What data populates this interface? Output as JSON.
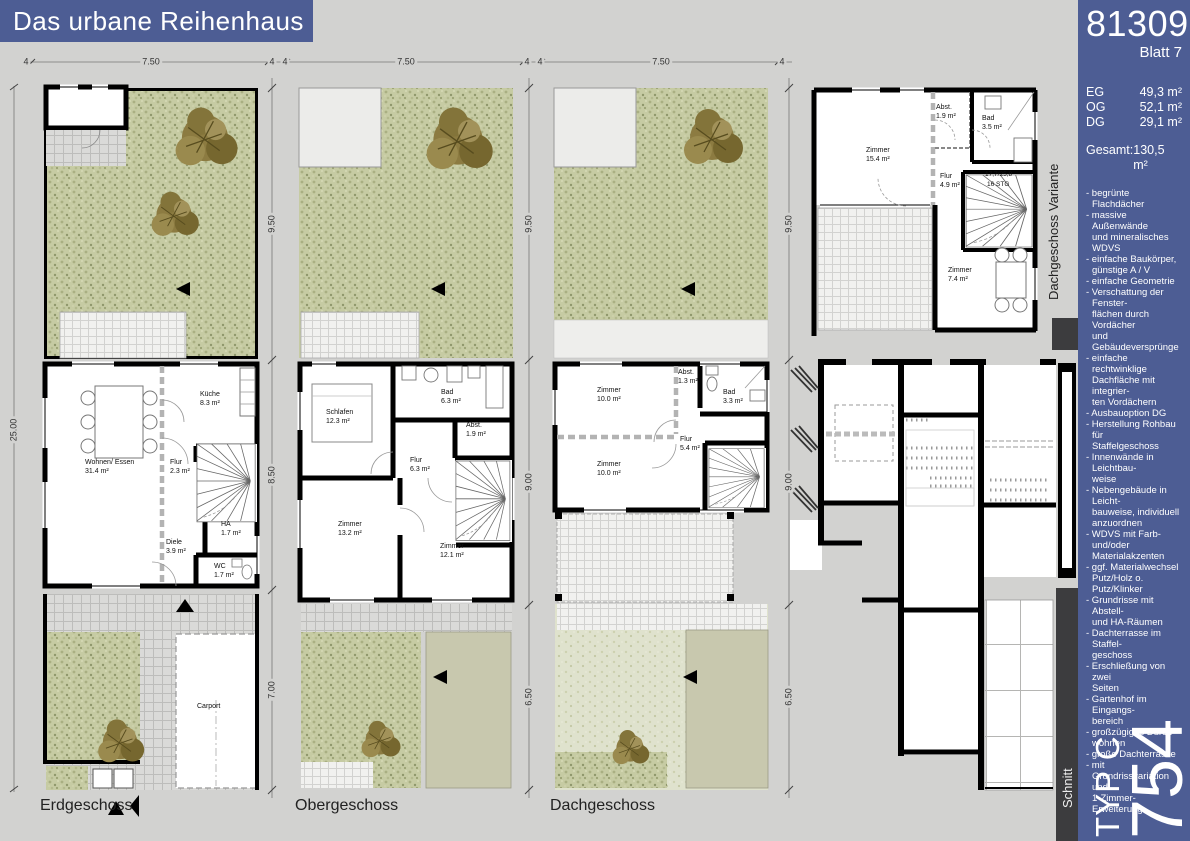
{
  "title": "Das urbane Reihenhaus",
  "sidebar": {
    "project_number": "813098",
    "sheet": "Blatt 7",
    "areas": [
      {
        "label": "EG",
        "value": "49,3 m²"
      },
      {
        "label": "OG",
        "value": "52,1 m²"
      },
      {
        "label": "DG",
        "value": "29,1 m²"
      }
    ],
    "total_label": "Gesamt:",
    "total_value": "130,5 m²",
    "features": [
      "- begrünte Flachdächer",
      "- massive Außenwände\nund mineralisches WDVS",
      "- einfache Baukörper,\ngünstige A / V",
      "- einfache Geometrie",
      "- Verschattung der Fenster-\nflächen durch Vordächer\nund Gebäudeversprünge",
      "- einfache rechtwinklige\nDachfläche mit integrier-\nten Vordächern",
      "- Ausbauoption DG",
      "- Herstellung Rohbau für\nStaffelgeschoss",
      "- Innenwände in Leichtbau-\nweise",
      "- Nebengebäude in Leicht-\nbauweise, individuell\nanzuordnen",
      "- WDVS mit Farb- und/oder\nMaterialakzenten",
      "- ggf. Materialwechsel\nPutz/Holz o. Putz/Klinker",
      "- Grundrisse mit Abstell-\nund HA-Räumen",
      "- Dachterrasse im Staffel-\ngeschoss",
      "- Erschließung von zwei\nSeiten",
      "- Gartenhof im Eingangs-\nbereich",
      "- großzügiges Durch-\nwohnen",
      "- große Dachterrasse",
      "- mit Grundrissvariation\nund\n1-Zimmer-Erweiterung"
    ],
    "type_label": "TYP C",
    "type_number": "754"
  },
  "section": {
    "label": "Schnitt"
  },
  "site": {
    "total_depth": "25.00"
  },
  "plans": {
    "eg": {
      "label": "Erdgeschoss",
      "dims_top": [
        "4",
        "7.50",
        "4"
      ],
      "dims_side": [
        "9.50",
        "8.50",
        "7.00"
      ],
      "rooms": [
        {
          "name": "Wohnen/ Essen",
          "area": "31.4 m²"
        },
        {
          "name": "Küche",
          "area": "8.3 m²"
        },
        {
          "name": "Flur",
          "area": "2.3 m²"
        },
        {
          "name": "HA",
          "area": "1.7 m²"
        },
        {
          "name": "Diele",
          "area": "3.9 m²"
        },
        {
          "name": "WC",
          "area": "1.7 m²"
        },
        {
          "name": "Carport",
          "area": ""
        }
      ]
    },
    "og": {
      "label": "Obergeschoss",
      "dims_top": [
        "4",
        "7.50",
        "4"
      ],
      "dims_side": [
        "9.50",
        "9.00",
        "6.50"
      ],
      "rooms": [
        {
          "name": "Schlafen",
          "area": "12.3 m²"
        },
        {
          "name": "Bad",
          "area": "6.3 m²"
        },
        {
          "name": "Abst.",
          "area": "1.9 m²"
        },
        {
          "name": "Flur",
          "area": "6.3 m²"
        },
        {
          "name": "Zimmer",
          "area": "13.2 m²"
        },
        {
          "name": "Zimmer",
          "area": "12.1 m²"
        }
      ]
    },
    "dg": {
      "label": "Dachgeschoss",
      "dims_top": [
        "4",
        "7.50",
        "4"
      ],
      "dims_side": [
        "9.50",
        "9.00",
        "6.50"
      ],
      "rooms": [
        {
          "name": "Zimmer",
          "area": "10.0 m²"
        },
        {
          "name": "Abst.",
          "area": "1.3 m²"
        },
        {
          "name": "Bad",
          "area": "3.3 m²"
        },
        {
          "name": "Flur",
          "area": "5.4 m²"
        },
        {
          "name": "Zimmer",
          "area": "10.0 m²"
        }
      ]
    },
    "variante": {
      "label": "Dachgeschoss Variante",
      "stair_note_1": "17,7/25,8",
      "stair_note_2": "16 STG",
      "rooms": [
        {
          "name": "Zimmer",
          "area": "15.4 m²"
        },
        {
          "name": "Abst.",
          "area": "1.9 m²"
        },
        {
          "name": "Bad",
          "area": "3.5 m²"
        },
        {
          "name": "Flur",
          "area": "4.9 m²"
        },
        {
          "name": "Zimmer",
          "area": "7.4 m²"
        }
      ]
    }
  },
  "colors": {
    "accent_blue": "#4d5d94",
    "panel_dark": "#3c3c3e",
    "garden_green": "#c6cba3",
    "tree_brown": "#8c7b41",
    "background": "#d2d2d0"
  }
}
